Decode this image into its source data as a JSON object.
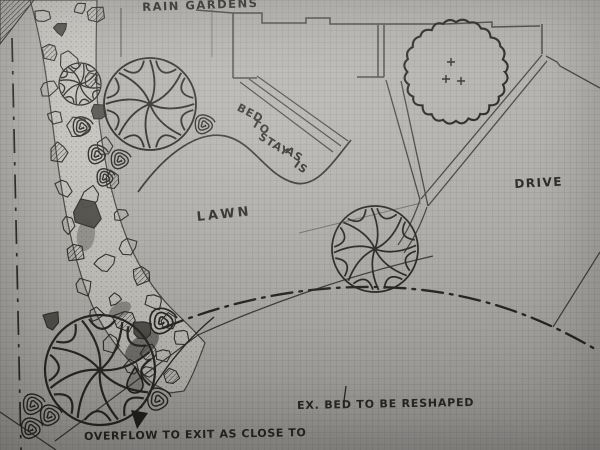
{
  "annotations": {
    "rain_gardens": "RAIN GARDENS",
    "bed_to_stay_words": [
      "BED",
      "TO",
      "STAY",
      "AS",
      "IS"
    ],
    "lawn": "LAWN",
    "drive": "DRIVE",
    "existing_bed": "EX. BED TO BE RESHAPED",
    "overflow": "OVERFLOW TO EXIT AS CLOSE TO"
  },
  "symbols": {
    "tree_symbol": "pinwheel-canopy-tree",
    "shrub_symbol": "spiral-shrub",
    "existing_shrub_mass": "scalloped-outline-with-plus-marks",
    "creek": "dry-creek-rock-band",
    "bed_line": "dash-dot-existing-bed-edge",
    "property_line": "dash-dot-property-line",
    "water_marker": "teardrop",
    "overflow_pointer": "curved-arrow"
  },
  "colors": {
    "paper": "#b3b1ad",
    "pencil": "#45443f",
    "ink_dark": "#23231f"
  }
}
